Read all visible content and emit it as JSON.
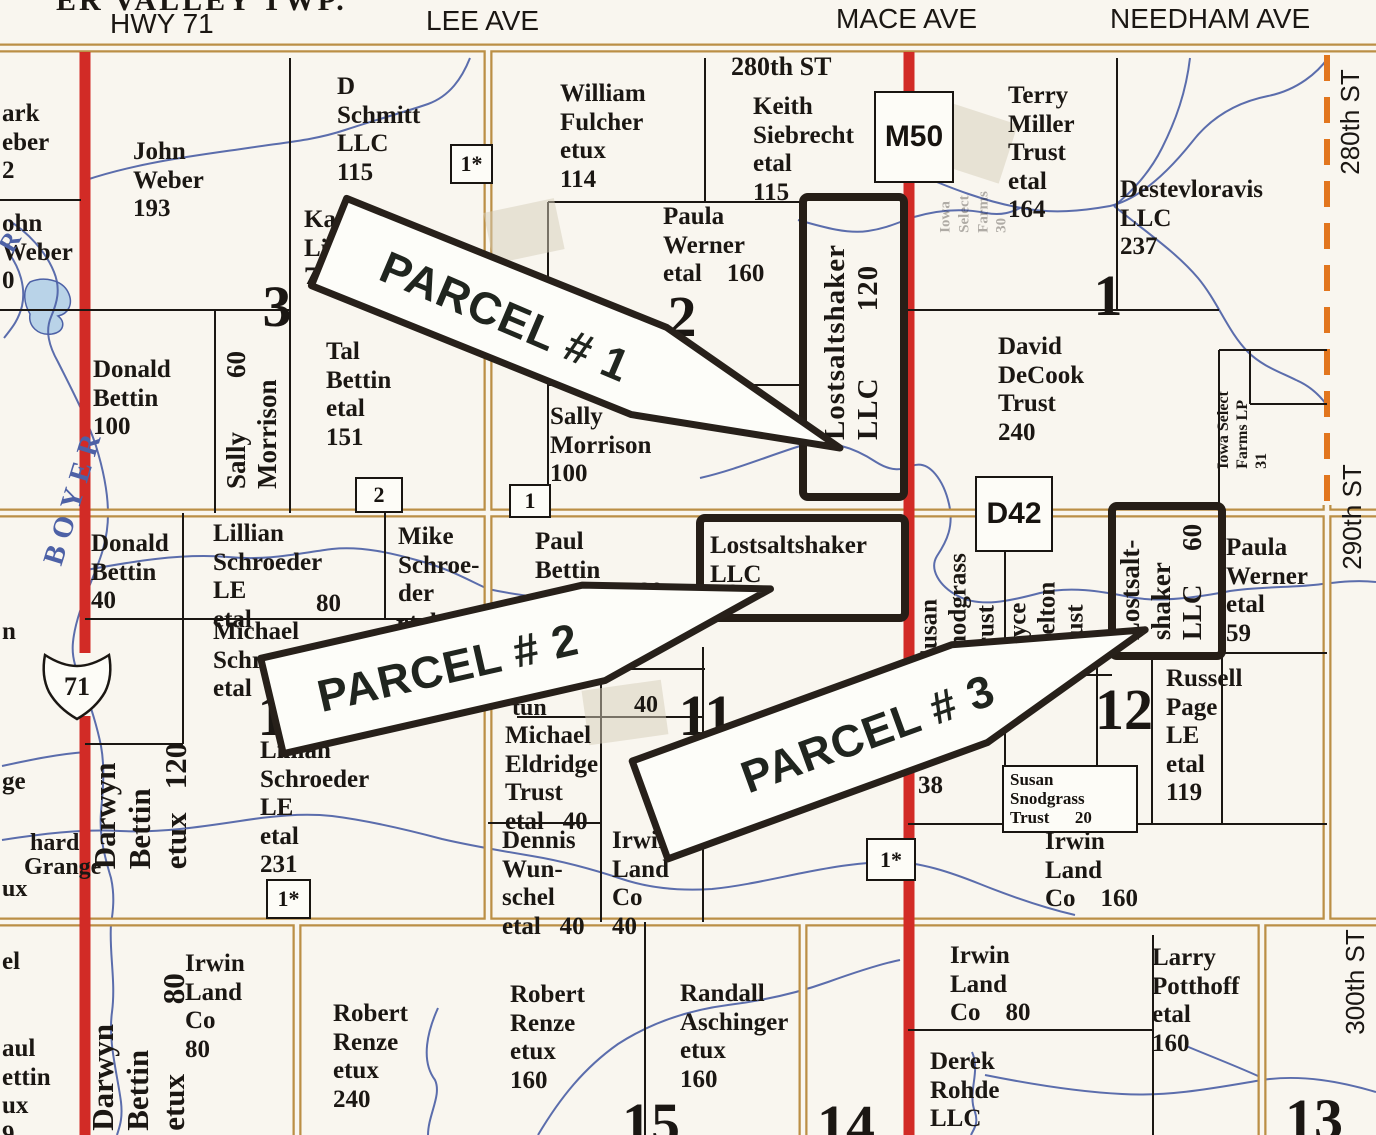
{
  "map_title": "ER VALLEY TWP.",
  "colors": {
    "paper": "#f9f6ef",
    "ink": "#1b1713",
    "road_tan": "#bb8f45",
    "road_red": "#d22b26",
    "dash_orange": "#e2761e",
    "water": "#4d61a6",
    "pond_fill": "#b9d3e8",
    "parcel_outline": "#261e17",
    "arrow_fill": "#fdfdf9"
  },
  "texts": [
    {
      "name": "township-label",
      "t": "ER VALLEY TWP.",
      "x": 56,
      "y": -16,
      "font": "serif",
      "size": 30,
      "weight": 700,
      "ls": 3
    },
    {
      "name": "road-label-hwy-71",
      "t": "HWY 71",
      "x": 110,
      "y": 8,
      "font": "sans",
      "size": 28,
      "weight": 400
    },
    {
      "name": "road-label-lee-ave",
      "t": "LEE AVE",
      "x": 426,
      "y": 5,
      "font": "sans",
      "size": 28,
      "weight": 400
    },
    {
      "name": "road-label-mace-ave",
      "t": "MACE AVE",
      "x": 836,
      "y": 3,
      "font": "sans",
      "size": 28,
      "weight": 400
    },
    {
      "name": "road-label-needham-ave",
      "t": "NEEDHAM AVE",
      "x": 1110,
      "y": 3,
      "font": "sans",
      "size": 28,
      "weight": 400
    },
    {
      "name": "road-label-280th-st-top",
      "t": "280th ST",
      "x": 731,
      "y": 52,
      "font": "serif",
      "size": 26
    },
    {
      "name": "road-label-280th-st-right",
      "t": "280th ST",
      "x": 1351,
      "y": 122,
      "anchor": "c",
      "rot": -90,
      "font": "sans",
      "size": 26,
      "weight": 400
    },
    {
      "name": "road-label-290th-st-right",
      "t": "290th ST",
      "x": 1353,
      "y": 517,
      "anchor": "c",
      "rot": -90,
      "font": "sans",
      "size": 26,
      "weight": 400
    },
    {
      "name": "road-label-300th-st-right",
      "t": "300th ST",
      "x": 1356,
      "y": 982,
      "anchor": "c",
      "rot": -90,
      "font": "sans",
      "size": 26,
      "weight": 400
    },
    {
      "name": "owner-mark-weber-fragment",
      "t": "ark\neber\n2",
      "x": 2,
      "y": 100
    },
    {
      "name": "owner-john-weber-fragment",
      "t": "ohn\nWeber\n0",
      "x": 2,
      "y": 210
    },
    {
      "name": "owner-john-weber",
      "t": "John\nWeber\n193",
      "x": 133,
      "y": 138
    },
    {
      "name": "owner-d-schmitt",
      "t": "D\nSchmitt\nLLC\n115",
      "x": 337,
      "y": 73
    },
    {
      "name": "owner-kath-lipp-fragment",
      "t": "Kathl\nLipp\n73",
      "x": 304,
      "y": 206
    },
    {
      "name": "owner-william-fulcher",
      "t": "William\nFulcher\netux\n114",
      "x": 560,
      "y": 80
    },
    {
      "name": "owner-keith-siebrecht",
      "t": "Keith\nSiebrecht\netal\n115",
      "x": 753,
      "y": 93
    },
    {
      "name": "owner-terry-miller",
      "t": "Terry\nMiller\nTrust\netal\n164",
      "x": 1008,
      "y": 82
    },
    {
      "name": "owner-destevloravis",
      "t": "Destevloravis\nLLC\n237",
      "x": 1120,
      "y": 176
    },
    {
      "name": "owner-paula-werner-160",
      "t": "Paula\nWerner\netal    160",
      "x": 663,
      "y": 203
    },
    {
      "name": "owner-tal-bettin",
      "t": "Tal\nBettin\netal\n151",
      "x": 326,
      "y": 338
    },
    {
      "name": "owner-sally-morrison-100",
      "t": "Sally\nMorrison\n100",
      "x": 550,
      "y": 403
    },
    {
      "name": "owner-donald-bettin-100",
      "t": "Donald\nBettin\n100",
      "x": 93,
      "y": 356
    },
    {
      "name": "owner-david-decook",
      "t": "David\nDeCook\nTrust\n240",
      "x": 998,
      "y": 333
    },
    {
      "name": "owner-donald-bettin-40",
      "t": "Donald\nBettin\n40",
      "x": 91,
      "y": 530
    },
    {
      "name": "owner-lillian-schroeder-80",
      "t": "Lillian\nSchroeder\nLE\netal",
      "x": 213,
      "y": 520
    },
    {
      "name": "acreage-lillian-80",
      "t": "80",
      "x": 316,
      "y": 590
    },
    {
      "name": "owner-mike-schroeder",
      "t": "Mike\nSchroe-\nder\netal  40",
      "x": 398,
      "y": 523
    },
    {
      "name": "fragment-le",
      "t": "Le",
      "x": 396,
      "y": 616,
      "size": 24
    },
    {
      "name": "owner-michael-schroeder",
      "t": "Michael\nSchroe\netal",
      "x": 213,
      "y": 618
    },
    {
      "name": "owner-paul-bettin",
      "t": "Paul\nBettin\netux",
      "x": 535,
      "y": 528
    },
    {
      "name": "acreage-paul-bettin-80",
      "t": "80",
      "x": 638,
      "y": 578
    },
    {
      "name": "parcel2-owner-label",
      "t": "Lostsaltshaker\nLLC",
      "x": 710,
      "y": 532
    },
    {
      "name": "parcel2-acreage-80",
      "t": "80",
      "x": 714,
      "y": 580
    },
    {
      "name": "owner-michael-eldridge",
      "t": "Michael\nEldridge\nTrust\netal   40",
      "x": 505,
      "y": 722
    },
    {
      "name": "owner-lillian-schroeder-231",
      "t": "Lillian\nSchroeder\nLE\netal\n231",
      "x": 260,
      "y": 737
    },
    {
      "name": "owner-dennis-wunschel",
      "t": "Dennis\nWun-\nschel\netal   40",
      "x": 502,
      "y": 827
    },
    {
      "name": "owner-irwin-land-co-40",
      "t": "Irwin\nLand\nCo\n40",
      "x": 612,
      "y": 827
    },
    {
      "name": "fragment-tun",
      "t": "tun",
      "x": 512,
      "y": 695,
      "size": 24
    },
    {
      "name": "acreage-40-section11",
      "t": "40",
      "x": 634,
      "y": 692,
      "size": 24
    },
    {
      "name": "acreage-38",
      "t": "38",
      "x": 918,
      "y": 772
    },
    {
      "name": "owner-susan-snodgrass-rotated",
      "t": "Susan\nSnodgrass\nTrust",
      "x": 958,
      "y": 608,
      "anchor": "c",
      "rot": -90
    },
    {
      "name": "owner-joyce-shelton-rotated",
      "t": "Joyce\nShelton\nTrust",
      "x": 1047,
      "y": 622,
      "anchor": "c",
      "rot": -90
    },
    {
      "name": "owner-russell-page",
      "t": "Russell\nPage\nLE\netal\n119",
      "x": 1166,
      "y": 665
    },
    {
      "name": "owner-paula-werner-59",
      "t": "Paula\nWerner\netal\n59",
      "x": 1226,
      "y": 534
    },
    {
      "name": "owner-irwin-land-co-160",
      "t": "Irwin\nLand\nCo    160",
      "x": 1045,
      "y": 828
    },
    {
      "name": "owner-irwin-land-co-80-east",
      "t": "Irwin\nLand\nCo    80",
      "x": 950,
      "y": 942
    },
    {
      "name": "owner-larry-potthoff",
      "t": "Larry\nPotthoff\netal\n160",
      "x": 1152,
      "y": 944
    },
    {
      "name": "owner-derek-rohde",
      "t": "Derek\nRohde\nLLC\n11",
      "x": 930,
      "y": 1048
    },
    {
      "name": "owner-robert-renze-240",
      "t": "Robert\nRenze\netux\n240",
      "x": 333,
      "y": 1000
    },
    {
      "name": "owner-robert-renze-160",
      "t": "Robert\nRenze\netux\n160",
      "x": 510,
      "y": 981
    },
    {
      "name": "owner-randall-aschinger",
      "t": "Randall\nAschinger\netux\n160",
      "x": 680,
      "y": 980
    },
    {
      "name": "owner-irwin-land-co-80-west",
      "t": "Irwin\nLand\nCo\n80",
      "x": 185,
      "y": 950
    },
    {
      "name": "fragment-n",
      "t": "n",
      "x": 2,
      "y": 618
    },
    {
      "name": "fragment-ge",
      "t": "ge",
      "x": 2,
      "y": 768
    },
    {
      "name": "fragment-hard",
      "t": "hard",
      "x": 30,
      "y": 830,
      "size": 24
    },
    {
      "name": "fragment-grange",
      "t": "Grange",
      "x": 24,
      "y": 854,
      "size": 24
    },
    {
      "name": "fragment-ux",
      "t": "ux",
      "x": 2,
      "y": 876,
      "size": 24
    },
    {
      "name": "fragment-el",
      "t": "el",
      "x": 2,
      "y": 948
    },
    {
      "name": "fragment-paul-bettin-left",
      "t": "aul\nettin\nux\n9",
      "x": 2,
      "y": 1035
    },
    {
      "name": "owner-sally-morrison-60-rotated",
      "t": "Sally        60\nMorrison",
      "x": 252,
      "y": 420,
      "anchor": "c",
      "rot": -90,
      "size": 27
    },
    {
      "name": "parcel1-owner-label-rotated",
      "t": "Lostsaltshaker\nLLC        120",
      "x": 852,
      "y": 342,
      "anchor": "c",
      "rot": -90,
      "size": 29,
      "ls": 1
    },
    {
      "name": "parcel3-owner-label-rotated",
      "t": "Lostsalt-\nshaker\nLLC     60",
      "x": 1161,
      "y": 582,
      "anchor": "c",
      "rot": -90,
      "size": 27
    },
    {
      "name": "owner-darwyn-bettin-120-rotated",
      "t": "Darwyn\nBettin\netux   120",
      "x": 140,
      "y": 806,
      "anchor": "c",
      "rot": -90,
      "size": 31
    },
    {
      "name": "owner-darwyn-bettin-80-rotated",
      "t": "Darwyn\nBettin\netux         80",
      "x": 138,
      "y": 1052,
      "anchor": "c",
      "rot": -90,
      "size": 31
    },
    {
      "name": "river-label-boyer",
      "t": "BOYER",
      "x": 74,
      "y": 496,
      "anchor": "c",
      "rot": -73,
      "size": 29,
      "color": "#4d61a6",
      "ls": 8,
      "weight": 700
    },
    {
      "name": "river-label-r",
      "t": "R",
      "x": 10,
      "y": 242,
      "anchor": "c",
      "rot": -60,
      "size": 26,
      "color": "#4d61a6",
      "weight": 700
    },
    {
      "name": "owner-iowa-select-31-rotated",
      "t": "Iowa Select\nFarms LP\n31",
      "x": 1243,
      "y": 430,
      "anchor": "c",
      "rot": -90,
      "size": 16,
      "lh": 1.2
    },
    {
      "name": "owner-iowa-select-30-faded",
      "t": "Iowa\nSelect\nFarms\n30",
      "x": 974,
      "y": 212,
      "anchor": "c",
      "rot": -90,
      "size": 15,
      "op": 0.33,
      "lh": 1.25
    },
    {
      "name": "section-number-3",
      "t": "3",
      "x": 277,
      "y": 307,
      "anchor": "c",
      "size": 58,
      "weight": 700
    },
    {
      "name": "section-number-2",
      "t": "2",
      "x": 682,
      "y": 317,
      "anchor": "c",
      "size": 58,
      "weight": 700
    },
    {
      "name": "section-number-1",
      "t": "1",
      "x": 1108,
      "y": 296,
      "anchor": "c",
      "size": 58,
      "weight": 700
    },
    {
      "name": "section-number-10",
      "t": "1",
      "x": 272,
      "y": 716,
      "anchor": "c",
      "size": 58,
      "weight": 700
    },
    {
      "name": "section-number-11",
      "t": "11",
      "x": 706,
      "y": 716,
      "anchor": "c",
      "size": 58,
      "weight": 700
    },
    {
      "name": "section-number-12",
      "t": "12",
      "x": 1124,
      "y": 710,
      "anchor": "c",
      "size": 58,
      "weight": 700
    },
    {
      "name": "section-number-15",
      "t": "15",
      "x": 651,
      "y": 1124,
      "anchor": "c",
      "size": 58,
      "weight": 700
    },
    {
      "name": "section-number-14",
      "t": "14",
      "x": 846,
      "y": 1126,
      "anchor": "c",
      "size": 58,
      "weight": 700
    },
    {
      "name": "section-number-13",
      "t": "13",
      "x": 1314,
      "y": 1120,
      "anchor": "c",
      "size": 58,
      "weight": 700
    }
  ],
  "boxes": [
    {
      "name": "marker-box-m50",
      "t": "M50",
      "x": 874,
      "y": 91,
      "w": 76,
      "h": 88,
      "size": 30,
      "sans": true
    },
    {
      "name": "marker-box-d42",
      "t": "D42",
      "x": 975,
      "y": 476,
      "w": 74,
      "h": 72,
      "size": 30,
      "sans": true
    },
    {
      "name": "marker-box-1star-north",
      "t": "1*",
      "x": 450,
      "y": 144,
      "w": 39,
      "h": 36,
      "size": 22
    },
    {
      "name": "marker-box-1star-west",
      "t": "1*",
      "x": 266,
      "y": 879,
      "w": 41,
      "h": 36,
      "size": 22
    },
    {
      "name": "marker-box-1star-mid",
      "t": "1*",
      "x": 866,
      "y": 838,
      "w": 46,
      "h": 39,
      "size": 22
    },
    {
      "name": "marker-box-2",
      "t": "2",
      "x": 355,
      "y": 477,
      "w": 44,
      "h": 32,
      "size": 22
    },
    {
      "name": "marker-box-1",
      "t": "1",
      "x": 509,
      "y": 484,
      "w": 38,
      "h": 30,
      "size": 22
    },
    {
      "name": "owner-box-susan-snodgrass-20",
      "t": "Susan\nSnodgrass\nTrust      20",
      "x": 1002,
      "y": 765,
      "w": 120,
      "h": 58,
      "size": 17,
      "multi": true
    }
  ],
  "parcels": [
    {
      "name": "parcel-1-outline",
      "x": 803,
      "y": 197,
      "w": 101,
      "h": 300
    },
    {
      "name": "parcel-2-outline",
      "x": 700,
      "y": 518,
      "w": 205,
      "h": 100
    },
    {
      "name": "parcel-3-outline",
      "x": 1112,
      "y": 506,
      "w": 110,
      "h": 150
    }
  ],
  "arrows": [
    {
      "name": "parcel-1-arrow",
      "label": "PARCEL # 1",
      "points": "346.6,198.4 666.6,327.4 840,448 631.4,414.6 311.4,285.6",
      "tx": 505,
      "ty": 317,
      "rot": 23
    },
    {
      "name": "parcel-2-arrow",
      "label": "PARCEL # 2",
      "points": "260.7,658.3 582.6,585.1 770.5,588.9 605.2,680.5 283.3,753.7",
      "tx": 448,
      "ty": 668,
      "rot": -12.8
    },
    {
      "name": "parcel-3-arrow",
      "label": "PARCEL # 3",
      "points": "632.2,761.1 951.7,644.8 1145.2,629.8 987.3,742.6 667.8,858.9",
      "tx": 868,
      "ty": 734,
      "rot": -20
    }
  ],
  "highway_shield": {
    "name": "us-71-shield",
    "t": "71",
    "cx": 77,
    "cy": 686,
    "path": "M 45,655 Q 62,666 77,666 Q 92,666 109,655 Q 113,676 105,692 Q 96,708 77,719 Q 58,708 49,692 Q 41,676 45,655 Z"
  },
  "black_lines": [
    [
      290,
      58,
      290,
      513
    ],
    [
      215,
      310,
      215,
      513
    ],
    [
      0,
      200,
      81,
      200
    ],
    [
      0,
      310,
      290,
      310
    ],
    [
      705,
      58,
      705,
      202
    ],
    [
      548,
      202,
      803,
      202
    ],
    [
      548,
      202,
      548,
      513
    ],
    [
      548,
      385,
      803,
      385
    ],
    [
      1117,
      58,
      1117,
      310
    ],
    [
      908,
      310,
      1219,
      310
    ],
    [
      1219,
      350,
      1219,
      513
    ],
    [
      1219,
      350,
      1327,
      350
    ],
    [
      1250,
      350,
      1250,
      404
    ],
    [
      1250,
      404,
      1327,
      404
    ],
    [
      183,
      513,
      183,
      744
    ],
    [
      85,
      744,
      183,
      744
    ],
    [
      85,
      619,
      488,
      619
    ],
    [
      385,
      513,
      385,
      619
    ],
    [
      601,
      669,
      601,
      922
    ],
    [
      703,
      647,
      703,
      922
    ],
    [
      601,
      669,
      705,
      669
    ],
    [
      517,
      717,
      703,
      717
    ],
    [
      488,
      823,
      601,
      823
    ],
    [
      1005,
      548,
      1005,
      766
    ],
    [
      1097,
      653,
      1097,
      824
    ],
    [
      1152,
      653,
      1152,
      824
    ],
    [
      1222,
      656,
      1222,
      824
    ],
    [
      1222,
      653,
      1327,
      653
    ],
    [
      1030,
      675,
      1112,
      675
    ],
    [
      908,
      824,
      1327,
      824
    ],
    [
      645,
      922,
      645,
      1135
    ],
    [
      1153,
      935,
      1153,
      1135
    ],
    [
      908,
      1030,
      1153,
      1030
    ]
  ],
  "tan_roads": [
    [
      0,
      48,
      1376,
      48
    ],
    [
      0,
      513,
      1376,
      513
    ],
    [
      0,
      922,
      1376,
      922
    ],
    [
      488,
      48,
      488,
      922
    ],
    [
      1327,
      505,
      1327,
      922
    ],
    [
      297,
      922,
      297,
      1135
    ],
    [
      803,
      922,
      803,
      1135
    ],
    [
      1262,
      922,
      1262,
      1135
    ]
  ],
  "red_roads": [
    [
      85,
      52,
      85,
      653
    ],
    [
      85,
      716,
      85,
      1135
    ],
    [
      909,
      52,
      909,
      1135
    ]
  ],
  "dashed_lines": [
    [
      1327,
      55,
      1327,
      505
    ]
  ],
  "streams": [
    "M 86,180 C 140,162 200,155 248,148 C 288,142 315,140 345,130 C 378,119 405,112 428,104 C 450,96 462,78 470,58",
    "M 8,220 C 28,232 46,252 54,272 C 61,289 57,303 51,317 C 45,331 49,346 58,362 C 70,386 86,416 96,446 C 104,472 108,494 108,514 C 108,542 99,562 91,582 C 83,602 75,622 73,642 C 71,660 78,674 85,690 C 91,708 97,726 101,746 C 105,768 103,790 101,812 C 99,836 105,858 111,878 C 115,896 113,912 111,924 C 109,952 116,982 112,1012 C 108,1042 117,1072 121,1102 C 123,1120 119,1128 117,1135",
    "M 8,252 C 20,268 26,288 22,306 C 18,322 10,330 4,338",
    "M 700,478 C 735,470 768,456 800,446 C 828,438 855,448 876,462 C 892,472 902,470 912,466 C 930,459 944,482 949,504 C 954,526 947,541 937,556 C 929,569 939,586 958,596 C 980,608 1010,601 1040,593 C 1070,586 1100,591 1130,597 C 1160,603 1200,597 1230,591 C 1262,586 1295,588 1322,584 C 1340,582 1356,580 1376,582",
    "M 798,220 C 826,228 848,234 868,231 C 888,228 899,222 914,217 C 938,210 962,208 986,213 C 1002,216 1012,212 1020,208",
    "M 913,172 C 950,188 986,202 1022,208 C 1052,214 1082,211 1110,206 C 1140,199 1168,172 1192,142 C 1212,116 1238,102 1268,96 C 1298,90 1318,72 1328,58",
    "M 1190,58 C 1186,92 1176,120 1162,148 C 1150,172 1132,192 1114,206",
    "M 1114,206 C 1146,232 1176,252 1198,278 C 1218,302 1228,332 1248,352 C 1262,366 1280,372 1296,380 C 1310,386 1320,396 1326,404",
    "M 86,570 C 130,562 180,553 228,557 C 268,561 300,553 332,549 C 362,546 392,553 420,561 C 450,569 470,581 488,589 C 520,596 552,599 582,601 C 612,603 642,601 666,599",
    "M 2,766 C 30,760 58,754 86,752",
    "M 2,840 C 40,834 80,829 120,831 C 160,833 200,827 240,821 C 272,816 302,813 332,816 C 372,821 412,831 442,839 C 472,846 502,851 532,856 C 562,861 592,869 622,879 C 652,889 682,891 712,889 C 742,886 772,879 802,873 C 832,867 862,862 892,862 C 920,862 950,872 980,884 C 1010,896 1045,908 1075,915",
    "M 538,1135 C 560,1098 584,1068 618,1044 C 652,1022 690,1010 728,1005 C 768,1000 800,992 828,982 C 856,972 880,964 900,960",
    "M 985,1075 C 1030,1084 1080,1092 1122,1094 C 1170,1097 1220,1087 1262,1080 C 1302,1074 1342,1082 1376,1092",
    "M 972,1052 C 981,1072 967,1092 975,1112 C 979,1124 973,1130 971,1135",
    "M 1186,1046 C 1210,1056 1236,1066 1258,1076",
    "M 438,1008 C 428,1030 420,1060 435,1080 C 442,1095 428,1115 428,1135"
  ],
  "pond_path": "M 30,282 C 44,276 62,280 68,292 C 74,304 68,314 58,316 C 66,322 64,332 52,334 C 38,336 28,326 30,314 C 24,304 22,290 30,282 Z",
  "smudges": [
    {
      "x": 488,
      "y": 205,
      "w": 72,
      "h": 52,
      "rot": -12
    },
    {
      "x": 585,
      "y": 685,
      "w": 80,
      "h": 55,
      "rot": -8
    },
    {
      "x": 938,
      "y": 112,
      "w": 72,
      "h": 62,
      "rot": 18
    }
  ],
  "tape_arrow_points": "398,656 332,656 332,646 300,674 332,700 332,692 398,692"
}
